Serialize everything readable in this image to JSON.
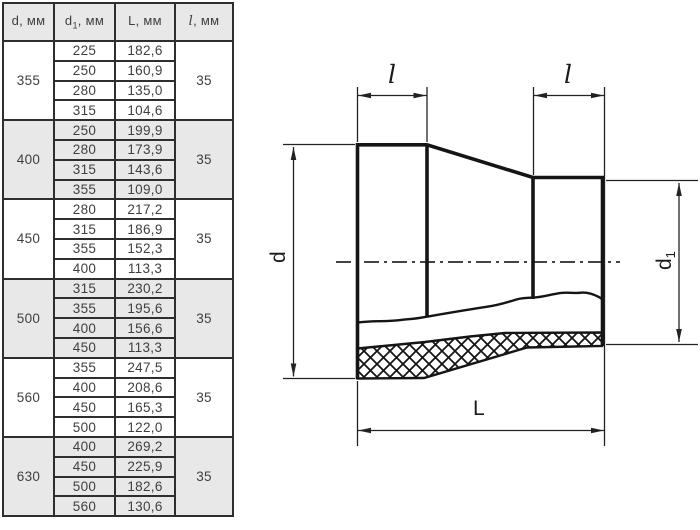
{
  "colors": {
    "table_border": "#2e2e2e",
    "table_text": "#3f3f3f",
    "row_shade": "#e8e8e8",
    "diagram_line": "#151515"
  },
  "table": {
    "headers": [
      {
        "sym": "d",
        "sub": "",
        "unit": ", мм"
      },
      {
        "sym": "d",
        "sub": "1",
        "unit": ", мм"
      },
      {
        "sym": "L",
        "sub": "",
        "unit": ", мм"
      },
      {
        "sym": "l",
        "sub": "",
        "unit": ", мм"
      }
    ],
    "groups": [
      {
        "d": "355",
        "l": "35",
        "rows": [
          {
            "d1": "225",
            "L": "182,6"
          },
          {
            "d1": "250",
            "L": "160,9"
          },
          {
            "d1": "280",
            "L": "135,0"
          },
          {
            "d1": "315",
            "L": "104,6"
          }
        ]
      },
      {
        "d": "400",
        "l": "35",
        "rows": [
          {
            "d1": "250",
            "L": "199,9"
          },
          {
            "d1": "280",
            "L": "173,9"
          },
          {
            "d1": "315",
            "L": "143,6"
          },
          {
            "d1": "355",
            "L": "109,0"
          }
        ]
      },
      {
        "d": "450",
        "l": "35",
        "rows": [
          {
            "d1": "280",
            "L": "217,2"
          },
          {
            "d1": "315",
            "L": "186,9"
          },
          {
            "d1": "355",
            "L": "152,3"
          },
          {
            "d1": "400",
            "L": "113,3"
          }
        ]
      },
      {
        "d": "500",
        "l": "35",
        "rows": [
          {
            "d1": "315",
            "L": "230,2"
          },
          {
            "d1": "355",
            "L": "195,6"
          },
          {
            "d1": "400",
            "L": "156,6"
          },
          {
            "d1": "450",
            "L": "113,3"
          }
        ]
      },
      {
        "d": "560",
        "l": "35",
        "rows": [
          {
            "d1": "355",
            "L": "247,5"
          },
          {
            "d1": "400",
            "L": "208,6"
          },
          {
            "d1": "450",
            "L": "165,3"
          },
          {
            "d1": "500",
            "L": "122,0"
          }
        ]
      },
      {
        "d": "630",
        "l": "35",
        "rows": [
          {
            "d1": "400",
            "L": "269,2"
          },
          {
            "d1": "450",
            "L": "225,9"
          },
          {
            "d1": "500",
            "L": "182,6"
          },
          {
            "d1": "560",
            "L": "130,6"
          }
        ]
      }
    ]
  },
  "diagram": {
    "labels": {
      "l_left": "l",
      "l_right": "l",
      "d": "d",
      "d1_sym": "d",
      "d1_sub": "1",
      "L": "L"
    }
  }
}
